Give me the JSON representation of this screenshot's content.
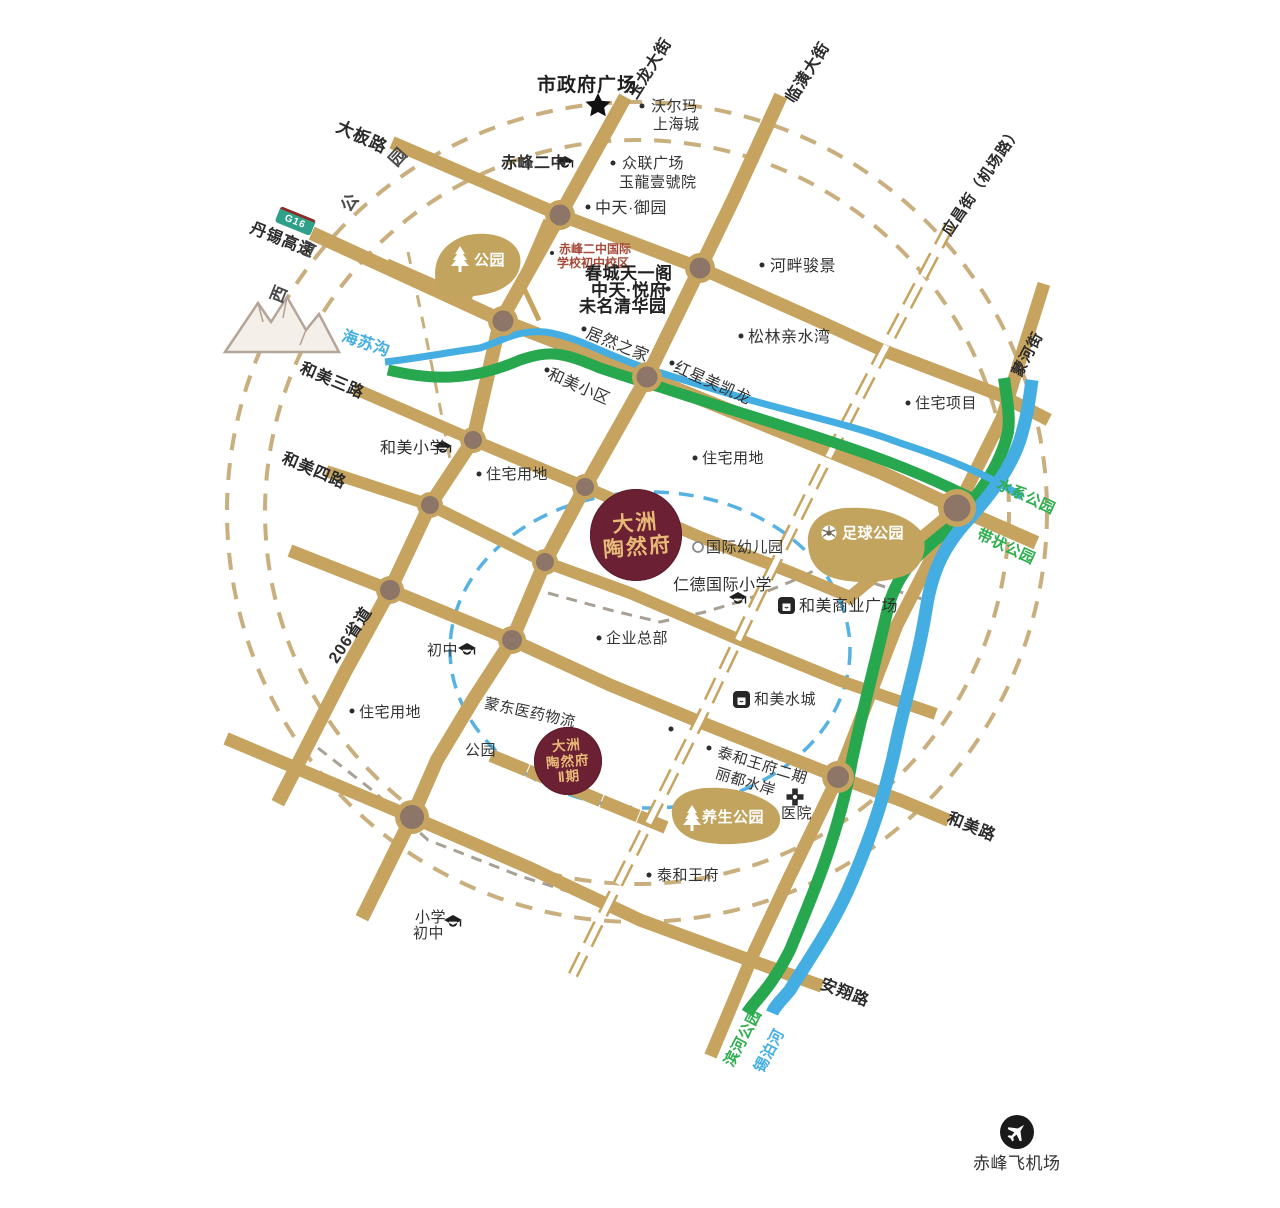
{
  "canvas": {
    "width": 1280,
    "height": 1208,
    "background": "#ffffff"
  },
  "colors": {
    "road_tan": "#c6a45f",
    "junction_node": "#8d7668",
    "dashed_radius_ring": "#c9ae7e",
    "blue_radius_ring": "#56b2e2",
    "river_blue": "#44aee2",
    "greenway_green": "#27a74e",
    "park_fill": "#c2a45f",
    "marker_burgundy": "#6b2133",
    "marker_gold": "#e7b977",
    "school_text_red": "#a44b3b",
    "g16_badge_green": "#2fa08a",
    "g16_badge_red": "#8d2b26"
  },
  "projects": {
    "main": {
      "l1": "大洲",
      "l2": "陶然府"
    },
    "phase2": {
      "l1": "大洲",
      "l2": "陶然府",
      "l3": "Ⅱ期"
    }
  },
  "roads": {
    "daban": "大板路",
    "yulong": "玉龙大街",
    "linhuang": "临潢大街",
    "yingchang": "应昌街（机场路）",
    "menghe": "蒙河街",
    "danxi": "丹锡高速",
    "g16": "G16",
    "hemei3": "和美三路",
    "hemei4": "和美四路",
    "s206": "206省道",
    "hemeilu": "和美路",
    "anxiang": "安翔路"
  },
  "waters": {
    "haisugou": "海苏沟",
    "xibohe": "锡泊河",
    "binhe_park": "滨河公园",
    "shuixi_park": "水系公园",
    "daizhuang_park": "带状公园"
  },
  "greens": {
    "park_nw": "公园",
    "park_small": "公园",
    "zuqiu": "足球公园",
    "yangsheng": "养生公园",
    "xishan_chars": [
      "西",
      "山",
      "公",
      "园"
    ]
  },
  "pois": {
    "city_hall": "市政府广场",
    "walmart_l1": "沃尔玛",
    "walmart_l2": "上海城",
    "cfez": "赤峰二中",
    "zhonglian_l1": "众联广场",
    "zhonglian_l2": "玉龍壹號院",
    "yuyuan": "中天·御园",
    "intl_l1": "赤峰二中国际",
    "intl_l2": "学校初中校区",
    "chuncheng_l1": "春城天一阁",
    "chuncheng_l2": "中天·悦府",
    "chuncheng_l3": "未名清华园",
    "hepan": "河畔骏景",
    "songlin": "松林亲水湾",
    "zhuzhai_xiangmu": "住宅项目",
    "juran": "居然之家",
    "hemei_xiaoqu": "和美小区",
    "hongxing": "红星美凯龙",
    "hemei_xiaoxue": "和美小学",
    "zhuzhai1": "住宅用地",
    "zhuzhai2": "住宅用地",
    "zhuzhai3": "住宅用地",
    "kindergarten": "国际幼儿园",
    "rende": "仁德国际小学",
    "shangye": "和美商业广场",
    "qiye": "企业总部",
    "chuzhong": "初中",
    "mengdong": "蒙东医药物流",
    "shuicheng": "和美水城",
    "taihe2_l1": "泰和王府二期",
    "taihe2_l2": "丽都水岸",
    "hospital": "医院",
    "taihe": "泰和王府",
    "xx_l1": "小学",
    "xx_l2": "初中",
    "airport": "赤峰飞机场"
  }
}
